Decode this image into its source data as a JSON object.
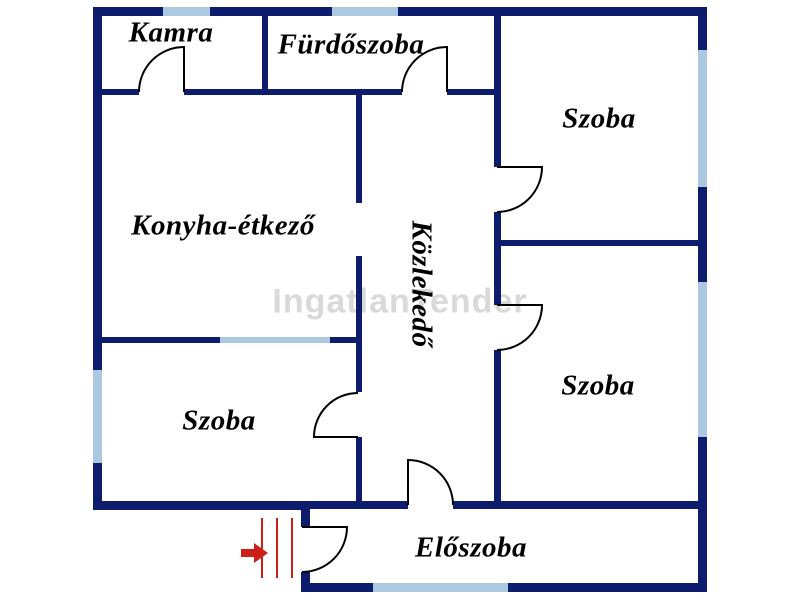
{
  "title": "Floor plan",
  "watermark": {
    "text": "IngatlanTender"
  },
  "rooms": {
    "kamra": {
      "label": "Kamra"
    },
    "furdoszoba": {
      "label": "Fürdőszoba"
    },
    "szoba_top_right": {
      "label": "Szoba"
    },
    "konyha_etkezo": {
      "label": "Konyha-étkező"
    },
    "kozlekedo": {
      "label": "Közlekedő"
    },
    "szoba_middle_right": {
      "label": "Szoba"
    },
    "szoba_bottom_left": {
      "label": "Szoba"
    },
    "eloszoba": {
      "label": "Előszoba"
    }
  },
  "icons": {
    "entrance_arrow": "entrance-arrow-icon",
    "entrance_steps": "entrance-steps-icon"
  },
  "colors": {
    "wall": "#0e1c6e",
    "window": "#adc9e2",
    "door": "#000000",
    "entrance": "#cc1f17",
    "watermark": "#d9d9d9",
    "text": "#000000",
    "background": "#ffffff"
  }
}
